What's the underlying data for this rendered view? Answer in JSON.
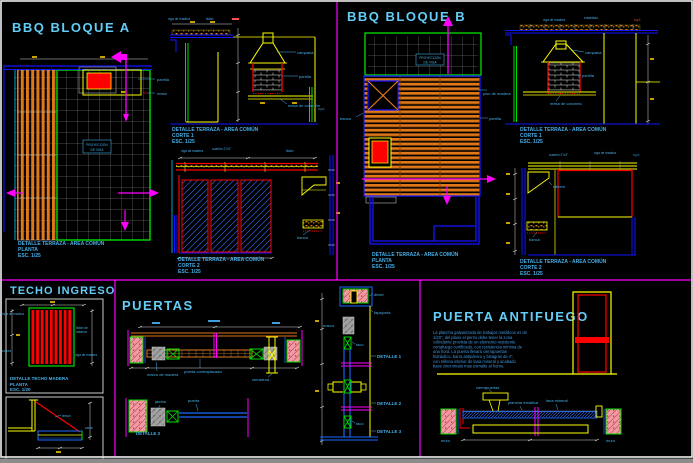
{
  "window": {
    "bg": "#000000",
    "frame": "#f0f0f0",
    "statusbar": "#8c8c8c",
    "divider": "#ff00ff"
  },
  "bbq_a": {
    "title": "BBQ BLOQUE A",
    "plan_caption": [
      "DETALLE TERRAZA - AREA COMÚN",
      "PLANTA",
      "ESC. 1/25"
    ],
    "corte1_caption": [
      "DETALLE TERRAZA - AREA COMÚN",
      "CORTE 1",
      "ESC. 1/25"
    ],
    "corte2_caption": [
      "DETALLE TERRAZA - AREA COMÚN",
      "CORTE 2",
      "ESC. 1/25"
    ],
    "labels": {
      "proyeccion_1": "PROYECCION",
      "proyeccion_2": "DE VIGA",
      "parrilla": "parrilla",
      "mesa": "mesa",
      "viga": "viga de madera",
      "liston": "listón",
      "campana": "campana",
      "parrilla_corte": "parrilla",
      "mesa_concreto": "mesa de concreto",
      "npt": "n.p.t.",
      "viga2": "viga de madera",
      "cuarton": "cuartón 2\"x3\"",
      "correa": "listón",
      "banca": "banca"
    }
  },
  "bbq_b": {
    "title": "BBQ BLOQUE B",
    "plan_caption": [
      "DETALLE TERRAZA - AREA COMÚN",
      "PLANTA",
      "ESC. 1/25"
    ],
    "corte1_caption": [
      "DETALLE TERRAZA - AREA COMÚN",
      "CORTE 1",
      "ESC. 1/25"
    ],
    "corte2_caption": [
      "DETALLE TERRAZA - AREA COMÚN",
      "CORTE 2",
      "ESC. 1/25"
    ],
    "labels": {
      "proyeccion_1": "PROYECCION",
      "proyeccion_2": "DE VIGA",
      "piso": "piso de madera",
      "parrilla": "parrilla",
      "banca": "banca",
      "viga": "viga de madera",
      "entablado": "entablado",
      "npt": "n.p.t.",
      "campana": "campana",
      "parrilla_corte": "parrilla",
      "mesa_concreto": "mesa de concreto",
      "cuarton": "cuartón 2\"x3\"",
      "viga2": "viga de madera",
      "npt2": "n.p.t.",
      "tablero": "tablero",
      "banca2": "banca"
    }
  },
  "techo": {
    "title": "TECHO INGRESO",
    "plan_caption": [
      "DETALLE TECHO MADERA",
      "PLANTA",
      "ESC. 1/20"
    ],
    "labels": {
      "viga": "viga de madera",
      "correa": "correa",
      "liston_1": "listón de",
      "liston_2": "madera",
      "viga2": "viga de madera",
      "tensor": "tensor",
      "canal": "canal"
    }
  },
  "puertas": {
    "title": "PUERTAS",
    "labels": {
      "marco": "marco de madera",
      "hoja": "puerta contraplacada",
      "cerradura": "cerradura",
      "jamba": "jamba",
      "puerta": "puerta",
      "detalle2_cap": "DETALLE 2",
      "d1": "DETALLE 1",
      "d2": "DETALLE 2",
      "d3": "DETALLE 3",
      "dintel": "dintel",
      "tapajunta": "tapajunta",
      "marco2": "marco",
      "taco1": "taco",
      "taco2": "taco"
    }
  },
  "antifuego": {
    "title": "PUERTA ANTIFUEGO",
    "spec": [
      "La plancha galvanizada de trabajos metálicos es de",
      "1/20\", del plano el perno debe tener la zona",
      "colindante provista de un elemento resistente",
      "cortafuego certificado, con resistencia mínima de",
      "una hora. La puerta llevará cierrapuertas",
      "hidráulico, barra antipánico y bisagras de 4\",",
      "con relleno interior de lana mineral y acabado",
      "base zincromato mas esmalte al horno."
    ],
    "labels": {
      "cierra": "cierrapuertas",
      "plancha": "plancha metálica",
      "lana": "lana mineral",
      "muro1": "muro",
      "muro2": "muro"
    }
  }
}
